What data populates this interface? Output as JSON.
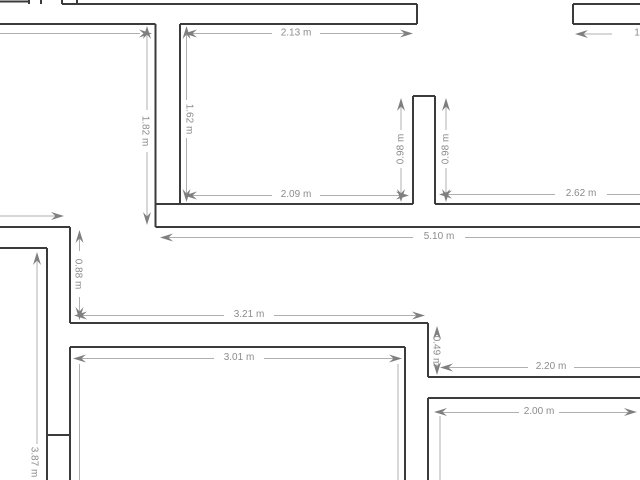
{
  "canvas": {
    "width": 640,
    "height": 480,
    "background": "#ffffff"
  },
  "style": {
    "wall_color": "#3b3b3b",
    "wall_stroke": 2,
    "dim_line_color": "#b0b0b0",
    "dim_line_stroke": 1,
    "dim_arrow_color": "#7f7f7f",
    "dim_text_color": "#8c8c8c",
    "dim_font_size": 10
  },
  "walls": [
    [
      0,
      1.5,
      30,
      1.5
    ],
    [
      29,
      0,
      29,
      4
    ],
    [
      41,
      0,
      41,
      4
    ],
    [
      62,
      0,
      62,
      4
    ],
    [
      77,
      0,
      77,
      4
    ],
    [
      62,
      4,
      417,
      4
    ],
    [
      417,
      4,
      417,
      24
    ],
    [
      0,
      24,
      155.5,
      24
    ],
    [
      180,
      24,
      417,
      24
    ],
    [
      573,
      4,
      573,
      24
    ],
    [
      573,
      4,
      640,
      4
    ],
    [
      573,
      24,
      640,
      24
    ],
    [
      155.5,
      24,
      155.5,
      227
    ],
    [
      180,
      24,
      180,
      204
    ],
    [
      155.5,
      204,
      413,
      204
    ],
    [
      435,
      204,
      640,
      204
    ],
    [
      155.5,
      227,
      640,
      227
    ],
    [
      413,
      96,
      435,
      96
    ],
    [
      413,
      96,
      413,
      204
    ],
    [
      435,
      96,
      435,
      204
    ],
    [
      0,
      227,
      70,
      227
    ],
    [
      70,
      227,
      70,
      323
    ],
    [
      0,
      248,
      47,
      248
    ],
    [
      47,
      248,
      47,
      480
    ],
    [
      70,
      347,
      70,
      480
    ],
    [
      47,
      435,
      70,
      435
    ],
    [
      70,
      323,
      428,
      323
    ],
    [
      428,
      323,
      428,
      377
    ],
    [
      428,
      377,
      640,
      377
    ],
    [
      70,
      347,
      405,
      347
    ],
    [
      405,
      347,
      405,
      480
    ],
    [
      428,
      398,
      640,
      398
    ],
    [
      428,
      398,
      428,
      480
    ]
  ],
  "dimension_lines": [
    [
      0,
      33.5,
      140,
      33.5
    ],
    [
      188,
      33.5,
      272,
      33.5
    ],
    [
      320,
      33.5,
      409,
      33.5
    ],
    [
      147,
      32,
      147,
      110
    ],
    [
      147,
      152,
      147,
      219
    ],
    [
      186.5,
      32,
      186.5,
      100
    ],
    [
      186.5,
      138,
      186.5,
      196
    ],
    [
      401,
      104,
      401,
      130
    ],
    [
      401,
      168,
      401,
      196
    ],
    [
      446,
      104,
      446,
      130
    ],
    [
      446,
      168,
      446,
      196
    ],
    [
      188,
      195.5,
      272,
      195.5
    ],
    [
      320,
      195.5,
      405,
      195.5
    ],
    [
      443,
      194.5,
      555,
      194.5
    ],
    [
      607,
      194.5,
      640,
      194.5
    ],
    [
      164,
      237.5,
      413,
      237.5
    ],
    [
      465,
      237.5,
      640,
      237.5
    ],
    [
      0,
      216,
      56,
      216
    ],
    [
      79.5,
      235,
      79.5,
      251
    ],
    [
      79.5,
      297,
      79.5,
      315
    ],
    [
      37,
      257,
      37,
      444
    ],
    [
      80,
      315.5,
      224,
      315.5
    ],
    [
      274,
      315.5,
      420,
      315.5
    ],
    [
      79,
      358.5,
      214,
      358.5
    ],
    [
      264,
      358.5,
      396,
      358.5
    ],
    [
      79.5,
      364,
      79.5,
      480
    ],
    [
      398,
      364,
      398,
      480
    ],
    [
      437,
      329,
      437,
      333
    ],
    [
      437,
      369,
      437,
      373
    ],
    [
      444,
      367.5,
      528,
      367.5
    ],
    [
      574,
      367.5,
      640,
      367.5
    ],
    [
      437,
      412.5,
      519,
      412.5
    ],
    [
      559,
      412.5,
      628,
      412.5
    ],
    [
      440,
      416,
      440,
      480
    ],
    [
      578,
      34,
      612,
      34
    ]
  ],
  "dimension_arrows": [
    {
      "x": 152,
      "y": 33.5,
      "dir": "right"
    },
    {
      "x": 184,
      "y": 33.5,
      "dir": "left"
    },
    {
      "x": 413,
      "y": 33.5,
      "dir": "right"
    },
    {
      "x": 147,
      "y": 26,
      "dir": "up"
    },
    {
      "x": 147,
      "y": 225,
      "dir": "down"
    },
    {
      "x": 186.5,
      "y": 26,
      "dir": "up"
    },
    {
      "x": 186.5,
      "y": 202,
      "dir": "down"
    },
    {
      "x": 401,
      "y": 98,
      "dir": "up"
    },
    {
      "x": 401,
      "y": 202,
      "dir": "down"
    },
    {
      "x": 446,
      "y": 98,
      "dir": "up"
    },
    {
      "x": 446,
      "y": 202,
      "dir": "down"
    },
    {
      "x": 184,
      "y": 195.5,
      "dir": "left"
    },
    {
      "x": 409,
      "y": 195.5,
      "dir": "right"
    },
    {
      "x": 439,
      "y": 194.5,
      "dir": "left"
    },
    {
      "x": 160,
      "y": 237.5,
      "dir": "left"
    },
    {
      "x": 64,
      "y": 216,
      "dir": "right"
    },
    {
      "x": 79.5,
      "y": 230,
      "dir": "up"
    },
    {
      "x": 79.5,
      "y": 320,
      "dir": "down"
    },
    {
      "x": 37,
      "y": 252,
      "dir": "up"
    },
    {
      "x": 74,
      "y": 315.5,
      "dir": "left"
    },
    {
      "x": 425,
      "y": 315.5,
      "dir": "right"
    },
    {
      "x": 73,
      "y": 358.5,
      "dir": "left"
    },
    {
      "x": 402,
      "y": 358.5,
      "dir": "right"
    },
    {
      "x": 437,
      "y": 326,
      "dir": "up"
    },
    {
      "x": 437,
      "y": 375,
      "dir": "down"
    },
    {
      "x": 440,
      "y": 367.5,
      "dir": "left"
    },
    {
      "x": 434,
      "y": 412,
      "dir": "left"
    },
    {
      "x": 637,
      "y": 412,
      "dir": "right"
    },
    {
      "x": 575,
      "y": 34,
      "dir": "left"
    }
  ],
  "dimension_labels": [
    {
      "text": "2.13 m",
      "x": 296,
      "y": 33,
      "rot": 0
    },
    {
      "text": "1.82 m",
      "x": 145,
      "y": 131,
      "rot": 90
    },
    {
      "text": "1.62 m",
      "x": 189,
      "y": 119,
      "rot": 90
    },
    {
      "text": "0.98 m",
      "x": 401,
      "y": 149,
      "rot": -90
    },
    {
      "text": "0.98 m",
      "x": 446,
      "y": 149,
      "rot": -90
    },
    {
      "text": "2.09 m",
      "x": 296,
      "y": 194.5,
      "rot": 0
    },
    {
      "text": "2.62 m",
      "x": 581,
      "y": 193.5,
      "rot": 0
    },
    {
      "text": "5.10 m",
      "x": 439,
      "y": 236.5,
      "rot": 0
    },
    {
      "text": "0.88 m",
      "x": 78,
      "y": 274,
      "rot": 90
    },
    {
      "text": "3.21 m",
      "x": 249,
      "y": 314.5,
      "rot": 0
    },
    {
      "text": "3.01 m",
      "x": 239,
      "y": 357.5,
      "rot": 0
    },
    {
      "text": "0.49 m",
      "x": 436,
      "y": 351,
      "rot": 90
    },
    {
      "text": "2.20 m",
      "x": 551,
      "y": 366.5,
      "rot": 0
    },
    {
      "text": "2.00 m",
      "x": 539,
      "y": 411.5,
      "rot": 0
    },
    {
      "text": "3.87 m",
      "x": 34,
      "y": 462,
      "rot": 90
    },
    {
      "text": "1",
      "x": 637,
      "y": 33,
      "rot": 0
    }
  ]
}
